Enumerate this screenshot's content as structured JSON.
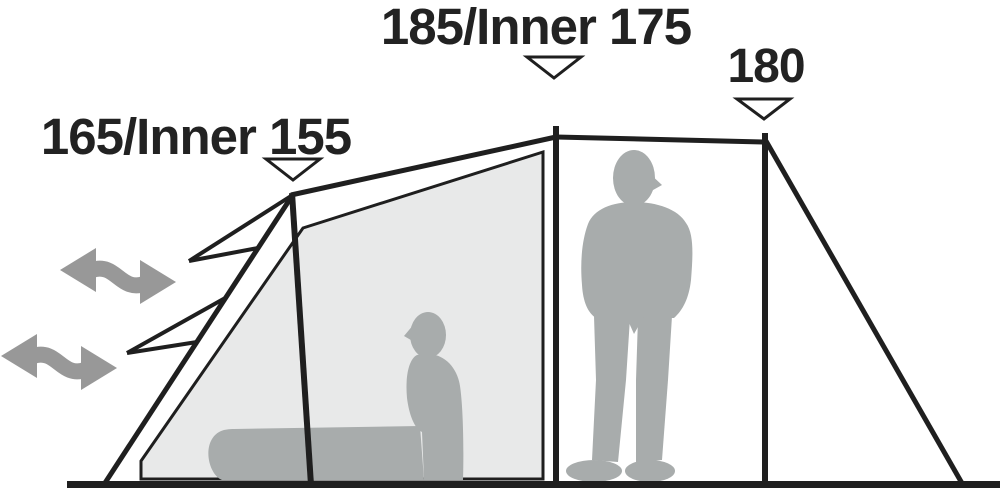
{
  "diagram": {
    "annotations": [
      {
        "id": "front-peak-height",
        "label": "165/Inner 155",
        "marker_icon": "down-triangle-icon"
      },
      {
        "id": "center-peak-height",
        "label": "185/Inner 175",
        "marker_icon": "down-triangle-icon"
      },
      {
        "id": "rear-peak-height",
        "label": "180",
        "marker_icon": "down-triangle-icon"
      }
    ],
    "icons": {
      "airflow": "double-headed-wavy-arrow-icon",
      "marker": "open-down-triangle-icon"
    },
    "colors": {
      "line": "#1f1f1f",
      "text": "#222222",
      "panel": "#e8e9e9",
      "silhouette": "#a8acac",
      "arrow": "#989898",
      "background": "#ffffff"
    }
  }
}
